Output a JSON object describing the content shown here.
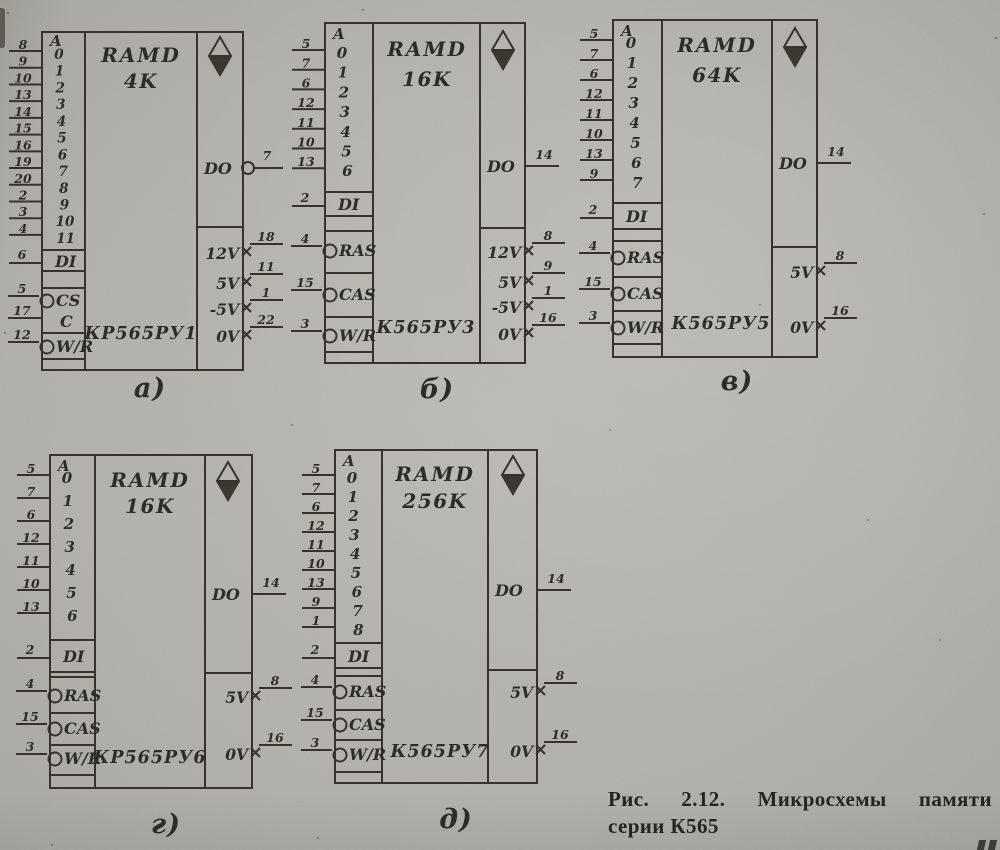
{
  "caption": {
    "line1": "Рис. 2.12. Микросхемы памяти",
    "line2": "серии К565"
  },
  "chips": [
    {
      "id": "a",
      "label": "а)",
      "device_type": "RAMD",
      "capacity": "4K",
      "part_number": "КР565РУ1",
      "address_header": "A",
      "address_bits": [
        "0",
        "1",
        "2",
        "3",
        "4",
        "5",
        "6",
        "7",
        "8",
        "9",
        "10",
        "11"
      ],
      "address_pins": [
        "8",
        "9",
        "10",
        "13",
        "14",
        "15",
        "16",
        "19",
        "20",
        "2",
        "3",
        "4"
      ],
      "data_in": {
        "label": "DI",
        "pin": "6"
      },
      "controls": [
        {
          "label": "CS",
          "pin": "5",
          "inverted": true
        },
        {
          "label": "C",
          "pin": "17",
          "inverted": false
        },
        {
          "label": "W/R",
          "pin": "12",
          "inverted": true
        }
      ],
      "data_out": {
        "label": "DO",
        "pin": "7",
        "inverted": true
      },
      "power": [
        {
          "label": "12V",
          "pin": "18"
        },
        {
          "label": "5V",
          "pin": "11"
        },
        {
          "label": "-5V",
          "pin": "1"
        },
        {
          "label": "0V",
          "pin": "22"
        }
      ]
    },
    {
      "id": "b",
      "label": "б)",
      "device_type": "RAMD",
      "capacity": "16K",
      "part_number": "К565РУ3",
      "address_header": "A",
      "address_bits": [
        "0",
        "1",
        "2",
        "3",
        "4",
        "5",
        "6"
      ],
      "address_pins": [
        "5",
        "7",
        "6",
        "12",
        "11",
        "10",
        "13"
      ],
      "data_in": {
        "label": "DI",
        "pin": "2"
      },
      "controls": [
        {
          "label": "RAS",
          "pin": "4",
          "inverted": true
        },
        {
          "label": "CAS",
          "pin": "15",
          "inverted": true
        },
        {
          "label": "W/R",
          "pin": "3",
          "inverted": true
        }
      ],
      "data_out": {
        "label": "DO",
        "pin": "14",
        "inverted": false
      },
      "power": [
        {
          "label": "12V",
          "pin": "8"
        },
        {
          "label": "5V",
          "pin": "9"
        },
        {
          "label": "-5V",
          "pin": "1"
        },
        {
          "label": "0V",
          "pin": "16"
        }
      ]
    },
    {
      "id": "v",
      "label": "в)",
      "device_type": "RAMD",
      "capacity": "64K",
      "part_number": "К565РУ5",
      "address_header": "A",
      "address_bits": [
        "0",
        "1",
        "2",
        "3",
        "4",
        "5",
        "6",
        "7"
      ],
      "address_pins": [
        "5",
        "7",
        "6",
        "12",
        "11",
        "10",
        "13",
        "9"
      ],
      "data_in": {
        "label": "DI",
        "pin": "2"
      },
      "controls": [
        {
          "label": "RAS",
          "pin": "4",
          "inverted": true
        },
        {
          "label": "CAS",
          "pin": "15",
          "inverted": true
        },
        {
          "label": "W/R",
          "pin": "3",
          "inverted": true
        }
      ],
      "data_out": {
        "label": "DO",
        "pin": "14",
        "inverted": false
      },
      "power": [
        {
          "label": "5V",
          "pin": "8"
        },
        {
          "label": "0V",
          "pin": "16"
        }
      ]
    },
    {
      "id": "g",
      "label": "г)",
      "device_type": "RAMD",
      "capacity": "16K",
      "part_number": "КР565РУ6",
      "address_header": "A",
      "address_bits": [
        "0",
        "1",
        "2",
        "3",
        "4",
        "5",
        "6"
      ],
      "address_pins": [
        "5",
        "7",
        "6",
        "12",
        "11",
        "10",
        "13"
      ],
      "data_in": {
        "label": "DI",
        "pin": "2"
      },
      "controls": [
        {
          "label": "RAS",
          "pin": "4",
          "inverted": true
        },
        {
          "label": "CAS",
          "pin": "15",
          "inverted": true
        },
        {
          "label": "W/R",
          "pin": "3",
          "inverted": true
        }
      ],
      "data_out": {
        "label": "DO",
        "pin": "14",
        "inverted": false
      },
      "power": [
        {
          "label": "5V",
          "pin": "8"
        },
        {
          "label": "0V",
          "pin": "16"
        }
      ]
    },
    {
      "id": "d",
      "label": "д)",
      "device_type": "RAMD",
      "capacity": "256K",
      "part_number": "К565РУ7",
      "address_header": "A",
      "address_bits": [
        "0",
        "1",
        "2",
        "3",
        "4",
        "5",
        "6",
        "7",
        "8"
      ],
      "address_pins": [
        "5",
        "7",
        "6",
        "12",
        "11",
        "10",
        "13",
        "9",
        "1"
      ],
      "data_in": {
        "label": "DI",
        "pin": "2"
      },
      "controls": [
        {
          "label": "RAS",
          "pin": "4",
          "inverted": true
        },
        {
          "label": "CAS",
          "pin": "15",
          "inverted": true
        },
        {
          "label": "W/R",
          "pin": "3",
          "inverted": true
        }
      ],
      "data_out": {
        "label": "DO",
        "pin": "14",
        "inverted": false
      },
      "power": [
        {
          "label": "5V",
          "pin": "8"
        },
        {
          "label": "0V",
          "pin": "16"
        }
      ]
    }
  ]
}
